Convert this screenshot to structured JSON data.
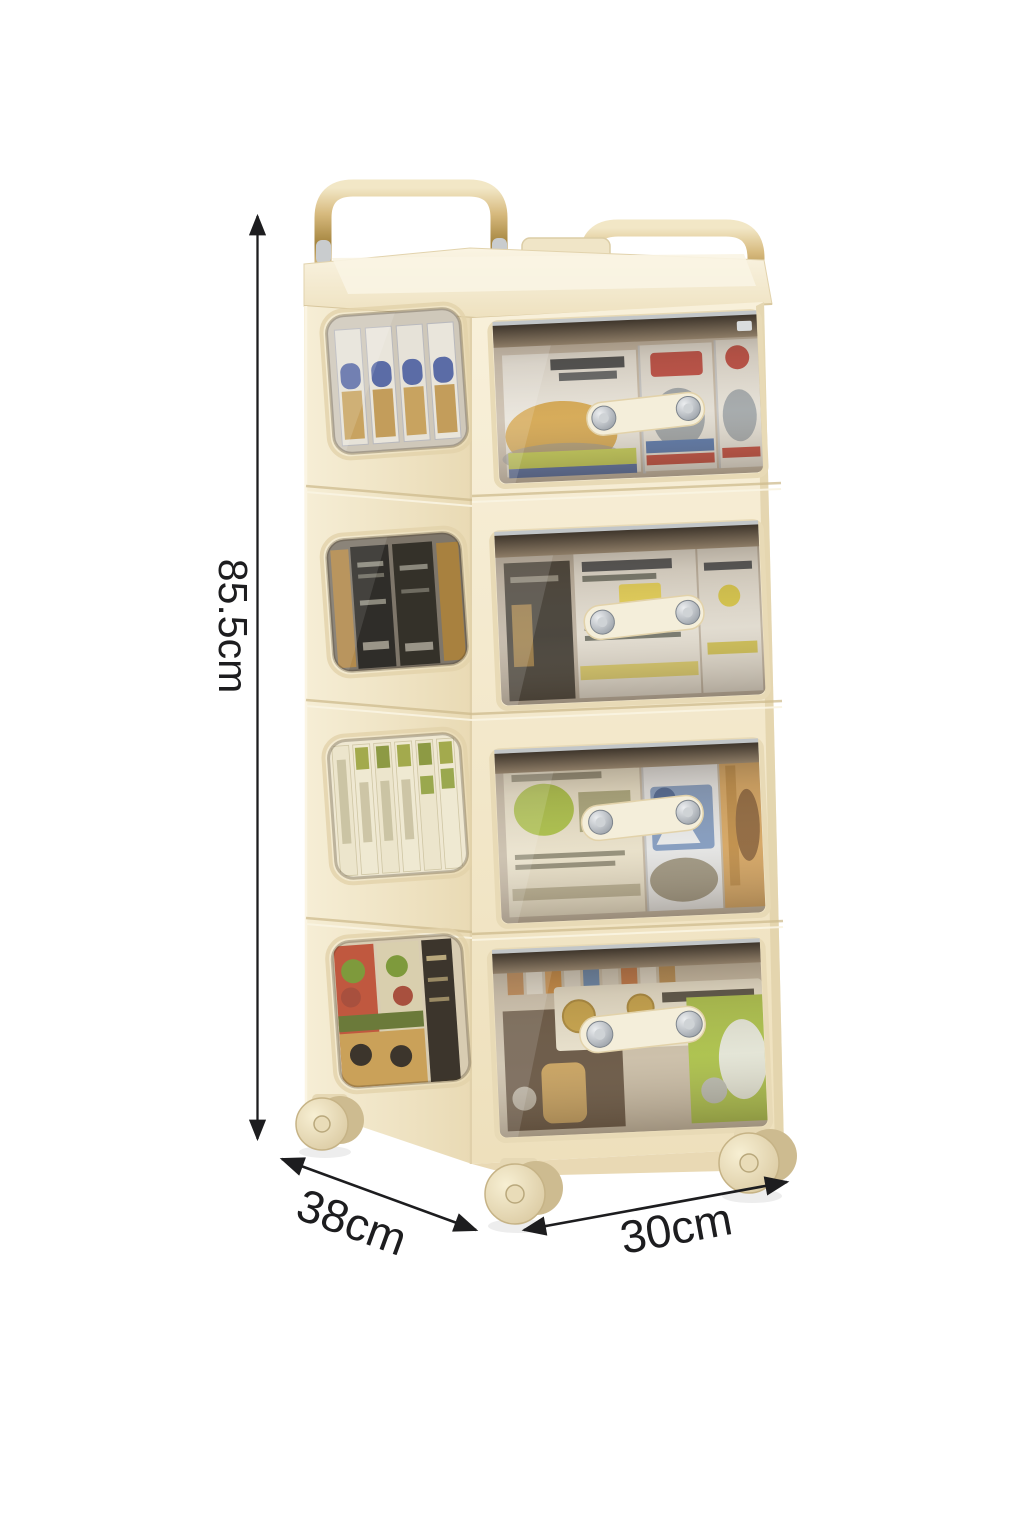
{
  "image": {
    "type": "product-photo",
    "subject": "4-tier rolling storage trolley with transparent drawers and carry handles",
    "view": "three-quarter front view on white background"
  },
  "annotations": {
    "height": {
      "label": "85.5cm"
    },
    "depth": {
      "label": "38cm"
    },
    "width": {
      "label": "30cm"
    }
  },
  "cart": {
    "tier_count": 4,
    "handle_count": 2,
    "visible_wheel_count": 3,
    "tiers": [
      {
        "name": "tier-1",
        "side_window": "upright-packets-blue-caps",
        "drawer": "instant-noodle-packs"
      },
      {
        "name": "tier-2",
        "side_window": "dark-sachet-boxes",
        "drawer": "white-packs-yellow-labels"
      },
      {
        "name": "tier-3",
        "side_window": "slim-green-label-boxes",
        "drawer": "assorted-snack-boxes"
      },
      {
        "name": "tier-4",
        "side_window": "printed-food-boxes",
        "drawer": "boxes-bottles-and-bread"
      }
    ]
  },
  "colors": {
    "background": "#ffffff",
    "ink": "#1d1d1f",
    "cream": "#f3e9cd",
    "cream-light": "#faf4e2",
    "cream-dark": "#e2d2aa",
    "cream-deep": "#cdbb8e",
    "gold": "#c3a45f",
    "gold-light": "#eedfb2",
    "gold-dark": "#95763a",
    "chrome": "#c9ccce",
    "handle-cream": "#f4eeda",
    "rivet": "#9aa2ab",
    "wheel": "#ecdfbd",
    "wheel-dark": "#cdbb90",
    "accent-red": "#bf4038",
    "accent-blue": "#5b6ca6",
    "accent-lime": "#c5d14e",
    "accent-olive": "#a3aa4d",
    "accent-green": "#a9c440",
    "accent-gold": "#c9a23f",
    "accent-brown": "#5d4b39"
  }
}
